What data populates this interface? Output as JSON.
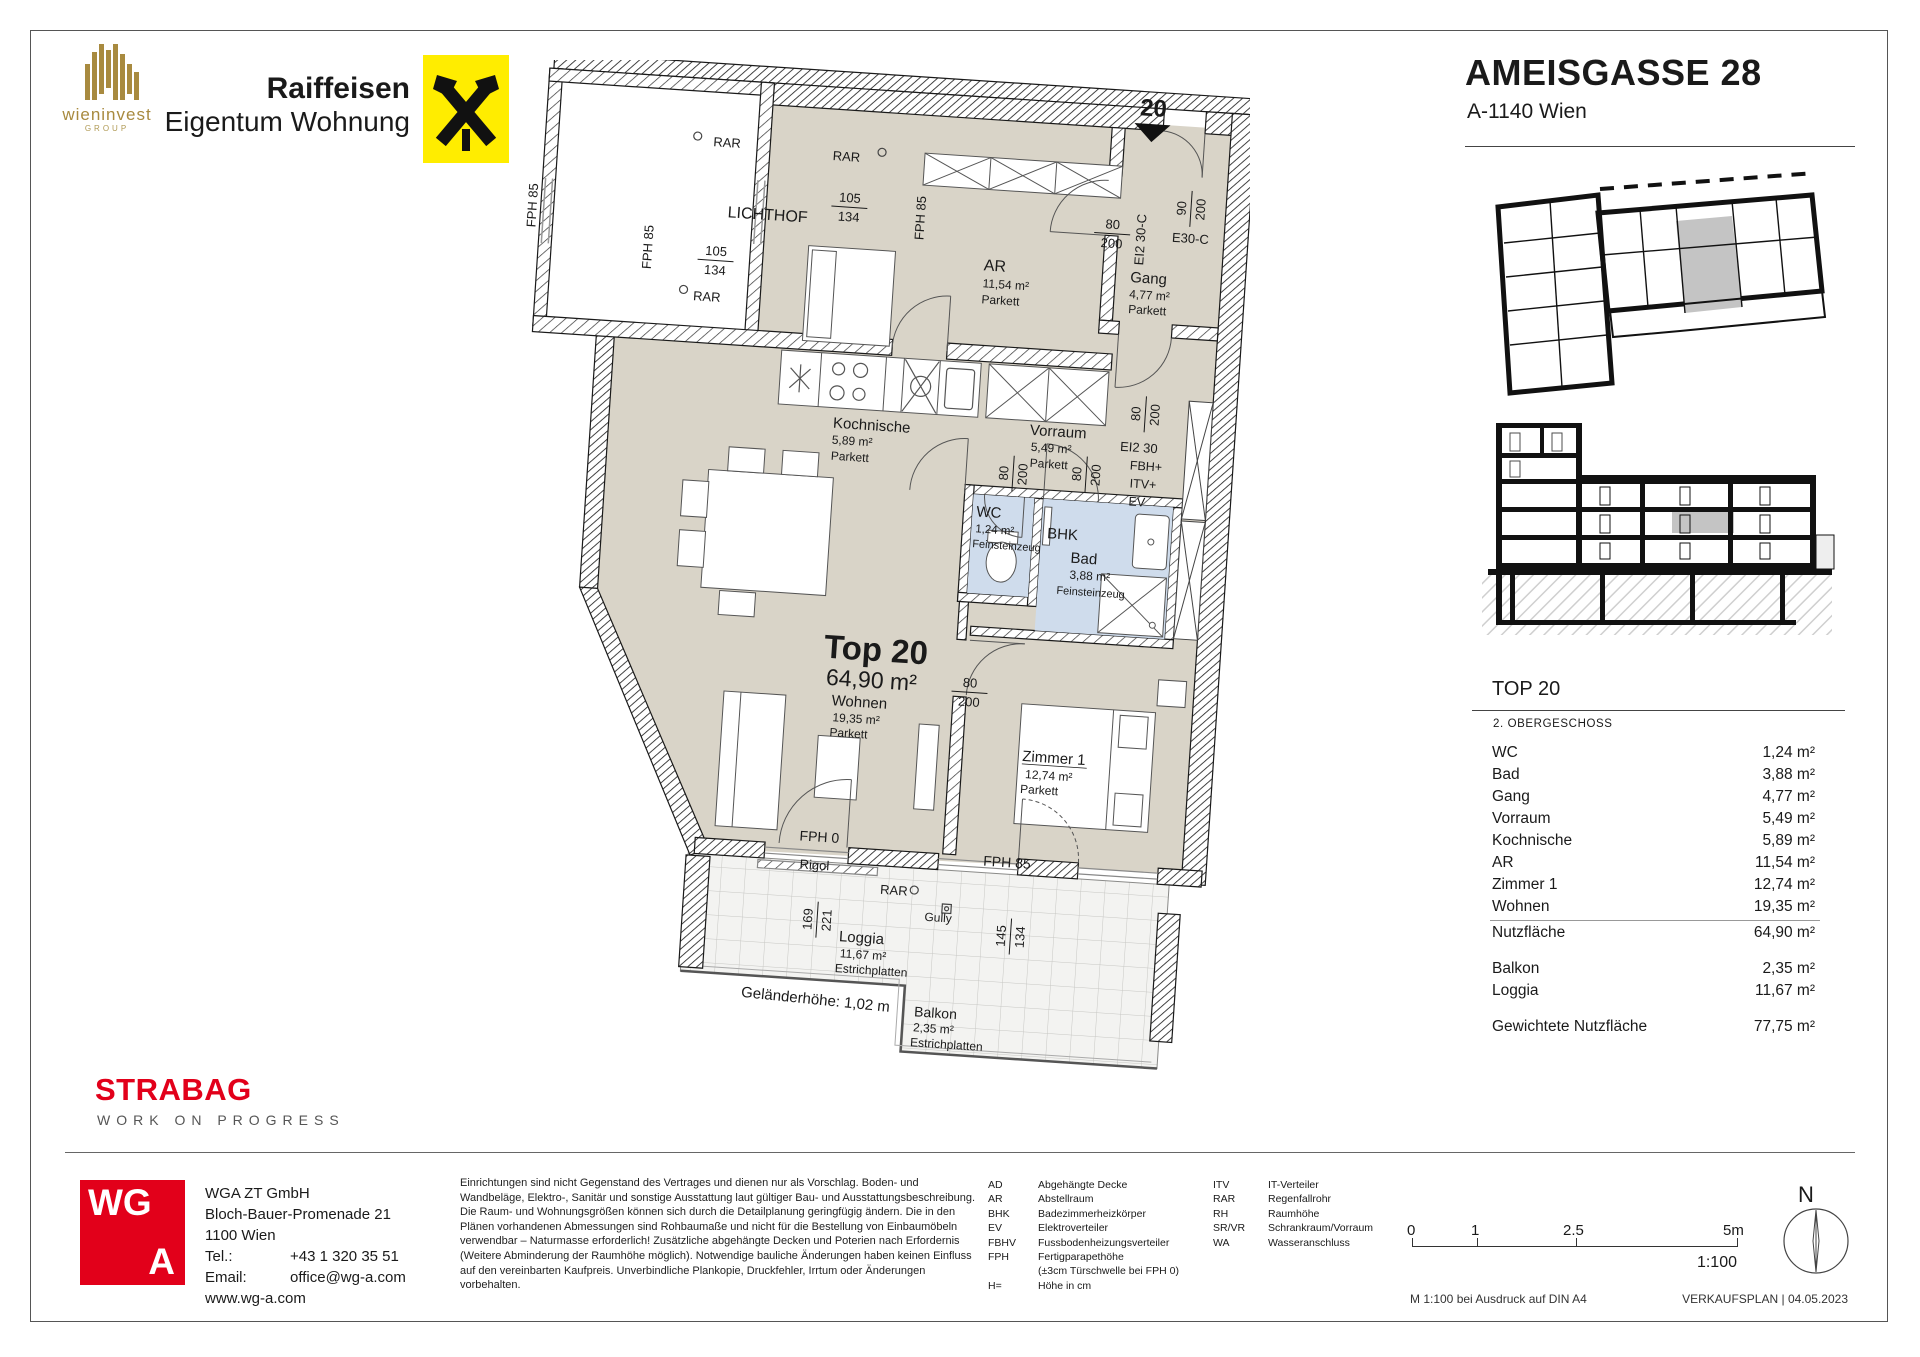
{
  "colors": {
    "accent_red": "#e2001a",
    "raiffeisen_yellow": "#ffed00",
    "wieninvest_gold": "#a88a3f",
    "room_beige": "#d9d4c8",
    "wet_blue": "#cfdcec",
    "unit_grey": "#c4c4c4"
  },
  "header": {
    "wieninvest_name": "wieninvest",
    "wieninvest_group": "GROUP",
    "raiffeisen_line1": "Raiffeisen",
    "raiffeisen_line2": "Eigentum Wohnung",
    "title": "AMEISGASSE 28",
    "subtitle": "A-1140 Wien"
  },
  "plan": {
    "unit_marker": "20",
    "rooms": {
      "top": {
        "name": "Top 20",
        "area": "64,90 m²"
      },
      "wohnen": {
        "name": "Wohnen",
        "area": "19,35 m²"
      },
      "zimmer1": {
        "name": "Zimmer 1",
        "area": "12,74 m²"
      },
      "kochnische": {
        "name": "Kochnische",
        "area": "5,89 m²"
      },
      "vorraum": {
        "name": "Vorraum",
        "area": "5,49 m²"
      },
      "gang": {
        "name": "Gang",
        "area": "4,77 m²"
      },
      "ar": {
        "name": "AR",
        "area": "11,54 m²"
      },
      "wc": {
        "name": "WC",
        "area": "1,24 m²"
      },
      "bad": {
        "name": "Bad",
        "area": "3,88 m²"
      },
      "loggia": {
        "name": "Loggia",
        "area": "11,67 m²"
      },
      "balkon": {
        "name": "Balkon",
        "area": "2,35 m²"
      }
    },
    "t": {
      "lichthof": "LICHTHOF",
      "rar": "RAR",
      "parkett": "Parkett",
      "feinsteinzeug": "Feinsteinzeug",
      "estrichplatten": "Estrichplatten",
      "fph85": "FPH 85",
      "fph0": "FPH 0",
      "bhk": "BHK",
      "fbh": "FBH+",
      "itv": "ITV+",
      "ev": "EV",
      "ei230": "EI2 30",
      "ei230c": "EI2 30-C",
      "e30c": "E30-C",
      "rigol": "Rigol",
      "gully": "Gully",
      "gelaender": "Geländerhöhe: 1,02 m",
      "n80": "80",
      "n200": "200",
      "n90": "90",
      "n105": "105",
      "n134": "134",
      "n169": "169",
      "n221": "221",
      "n145": "145"
    }
  },
  "panel": {
    "top_label": "TOP 20",
    "floor": "2. OBERGESCHOSS",
    "rows": [
      {
        "label": "WC",
        "value": "1,24 m²"
      },
      {
        "label": "Bad",
        "value": "3,88 m²"
      },
      {
        "label": "Gang",
        "value": "4,77 m²"
      },
      {
        "label": "Vorraum",
        "value": "5,49 m²"
      },
      {
        "label": "Kochnische",
        "value": "5,89 m²"
      },
      {
        "label": "AR",
        "value": "11,54 m²"
      },
      {
        "label": "Zimmer 1",
        "value": "12,74 m²"
      },
      {
        "label": "Wohnen",
        "value": "19,35 m²"
      }
    ],
    "total": {
      "label": "Nutzfläche",
      "value": "64,90 m²"
    },
    "outdoor": [
      {
        "label": "Balkon",
        "value": "2,35 m²"
      },
      {
        "label": "Loggia",
        "value": "11,67 m²"
      }
    ],
    "weighted": {
      "label": "Gewichtete Nutzfläche",
      "value": "77,75 m²"
    }
  },
  "footer": {
    "strabag": "STRABAG",
    "strabag_sub": "WORK ON PROGRESS",
    "wga": {
      "wg": "WG",
      "a": "A"
    },
    "contact": {
      "company": "WGA ZT GmbH",
      "street": "Bloch-Bauer-Promenade 21",
      "city": "1100 Wien",
      "tel_label": "Tel.:",
      "tel": "+43 1 320 35 51",
      "email_label": "Email:",
      "email": "office@wg-a.com",
      "web": "www.wg-a.com"
    },
    "disclaimer": "Einrichtungen sind nicht Gegenstand des Vertrages und dienen nur als Vorschlag. Boden- und Wandbeläge, Elektro-, Sanitär und sonstige Ausstattung laut gültiger Bau- und Ausstattungsbeschreibung. Die Raum- und Wohnungsgrößen können sich durch die Detailplanung geringfügig ändern. Die in den Plänen vorhandenen Abmessungen sind Rohbaumaße und nicht für die Bestellung von Einbaumöbeln verwendbar – Naturmasse erforderlich! Zusätzliche abgehängte Decken und Poterien nach Erfordernis (Weitere Abminderung der Raumhöhe möglich). Notwendige bauliche Änderungen haben keinen Einfluss auf den vereinbarten Kaufpreis. Unverbindliche Plankopie, Druckfehler, Irrtum oder Änderungen vorbehalten.",
    "legend1": [
      {
        "abbr": "AD",
        "term": "Abgehängte Decke"
      },
      {
        "abbr": "AR",
        "term": "Abstellraum"
      },
      {
        "abbr": "BHK",
        "term": "Badezimmerheizkörper"
      },
      {
        "abbr": "EV",
        "term": "Elektroverteiler"
      },
      {
        "abbr": "FBHV",
        "term": "Fussbodenheizungsverteiler"
      },
      {
        "abbr": "FPH",
        "term": "Fertigparapethöhe"
      },
      {
        "abbr": "",
        "term": "(±3cm Türschwelle bei FPH 0)"
      },
      {
        "abbr": "H=",
        "term": "Höhe in cm"
      }
    ],
    "legend2": [
      {
        "abbr": "ITV",
        "term": "IT-Verteiler"
      },
      {
        "abbr": "RAR",
        "term": "Regenfallrohr"
      },
      {
        "abbr": "RH",
        "term": "Raumhöhe"
      },
      {
        "abbr": "SR/VR",
        "term": "Schrankraum/Vorraum"
      },
      {
        "abbr": "WA",
        "term": "Wasseranschluss"
      }
    ],
    "scale": {
      "t0": "0",
      "t1": "1",
      "t2": "2.5",
      "t3": "5m",
      "ratio": "1:100",
      "print_note": "M 1:100 bei Ausdruck auf DIN A4",
      "doc": "VERKAUFSPLAN | 04.05.2023",
      "north": "N"
    }
  }
}
